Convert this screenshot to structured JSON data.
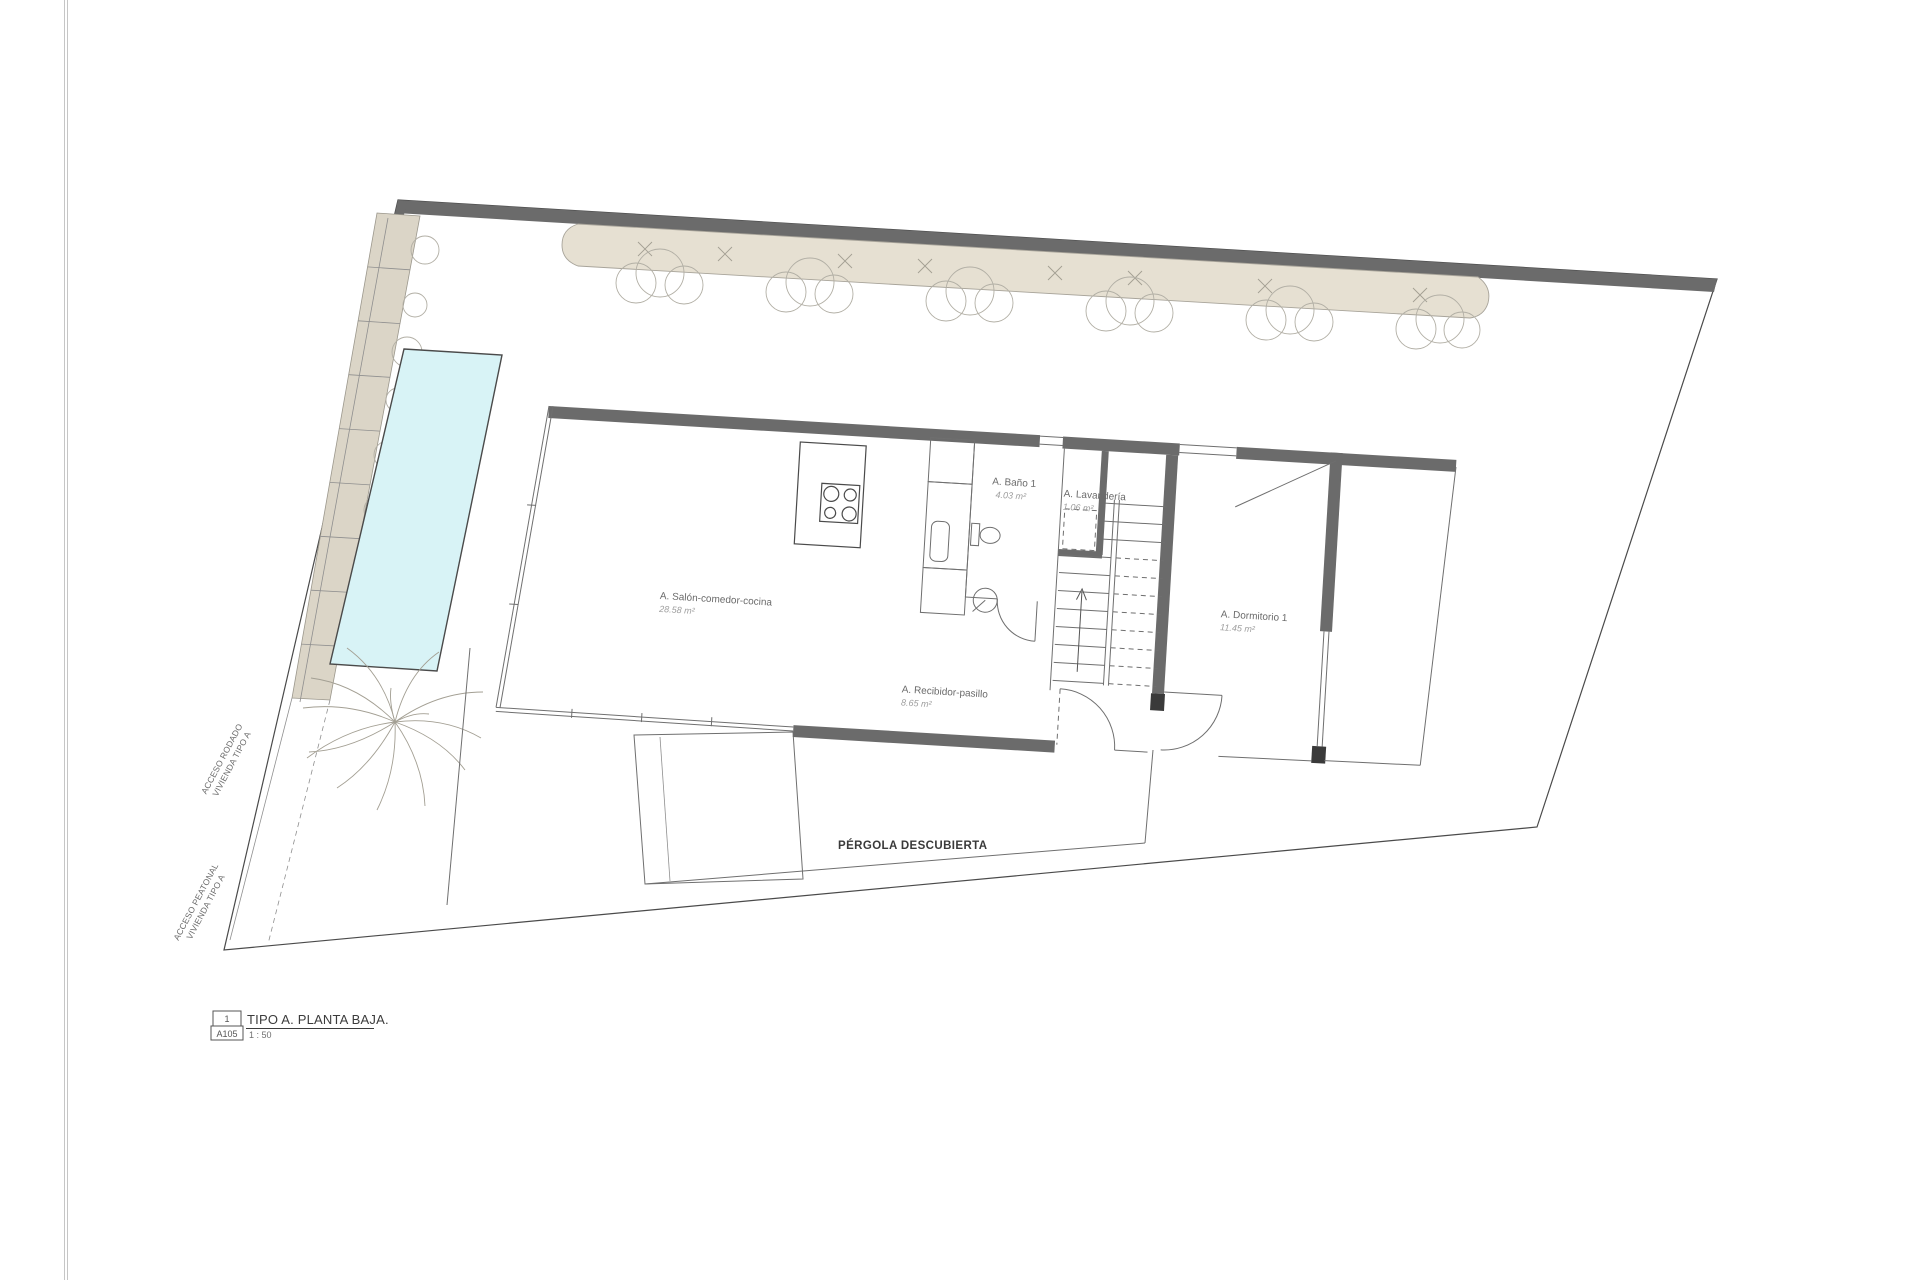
{
  "sheet": {
    "view_number": "1",
    "sheet_code": "A105",
    "view_title": "TIPO A. PLANTA BAJA.",
    "scale": "1 : 50"
  },
  "rooms": [
    {
      "name": "A. Salón-comedor-cocina",
      "area": "28.58 m²"
    },
    {
      "name": "A. Baño 1",
      "area": "4.03 m²"
    },
    {
      "name": "A. Lavandería",
      "area": "1.06 m²"
    },
    {
      "name": "A. Dormitorio 1",
      "area": "11.45 m²"
    },
    {
      "name": "A. Recibidor-pasillo",
      "area": "8.65 m²"
    }
  ],
  "site": {
    "pergola_label": "PÉRGOLA DESCUBIERTA",
    "acceso_rodado_line1": "ACCESO RODADO",
    "acceso_rodado_line2": "VIVIENDA TIPO A",
    "acceso_peatonal_line1": "ACCESO PEATONAL",
    "acceso_peatonal_line2": "VIVIENDA TIPO A"
  },
  "colors": {
    "wall": "#6b6b6b",
    "pool": "#d8f3f6",
    "planting_bed": "#e6e0d2",
    "driveway": "#dbd5c7",
    "line": "#4a4a4a",
    "label": "#6a6a6a",
    "area_label": "#9e9e9e"
  }
}
